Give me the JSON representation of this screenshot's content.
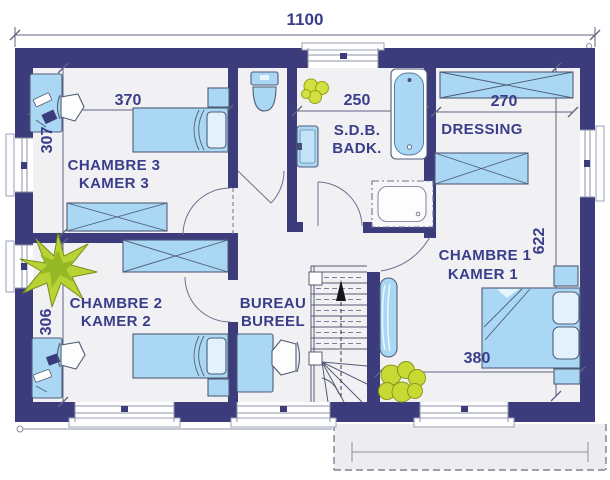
{
  "dimensions": {
    "overall_width": "1100",
    "chambre3_width": "370",
    "chambre3_depth": "307",
    "chambre2_depth": "306",
    "bathroom_width": "250",
    "dressing_width": "270",
    "east_wing_depth": "622",
    "chambre1_width": "380"
  },
  "rooms": {
    "chambre3": {
      "label_fr": "CHAMBRE 3",
      "label_nl": "KAMER 3"
    },
    "chambre2": {
      "label_fr": "CHAMBRE 2",
      "label_nl": "KAMER 2"
    },
    "bureau": {
      "label_fr": "BUREAU",
      "label_nl": "BUREEL"
    },
    "bathroom": {
      "label_fr": "S.D.B.",
      "label_nl": "BADK."
    },
    "dressing": {
      "label": "DRESSING"
    },
    "chambre1": {
      "label_fr": "CHAMBRE 1",
      "label_nl": "KAMER 1"
    }
  },
  "colors": {
    "wall": "#3c3c7c",
    "floor": "#f1f1f4",
    "furniture_fill": "#a9d7f4",
    "pillow_fill": "#e2f1fc",
    "label_text": "#3a3d8a",
    "plant_green": "#b9d335",
    "plant_yellow_green": "#d0dd3c",
    "dimension_line": "#5f6483"
  }
}
